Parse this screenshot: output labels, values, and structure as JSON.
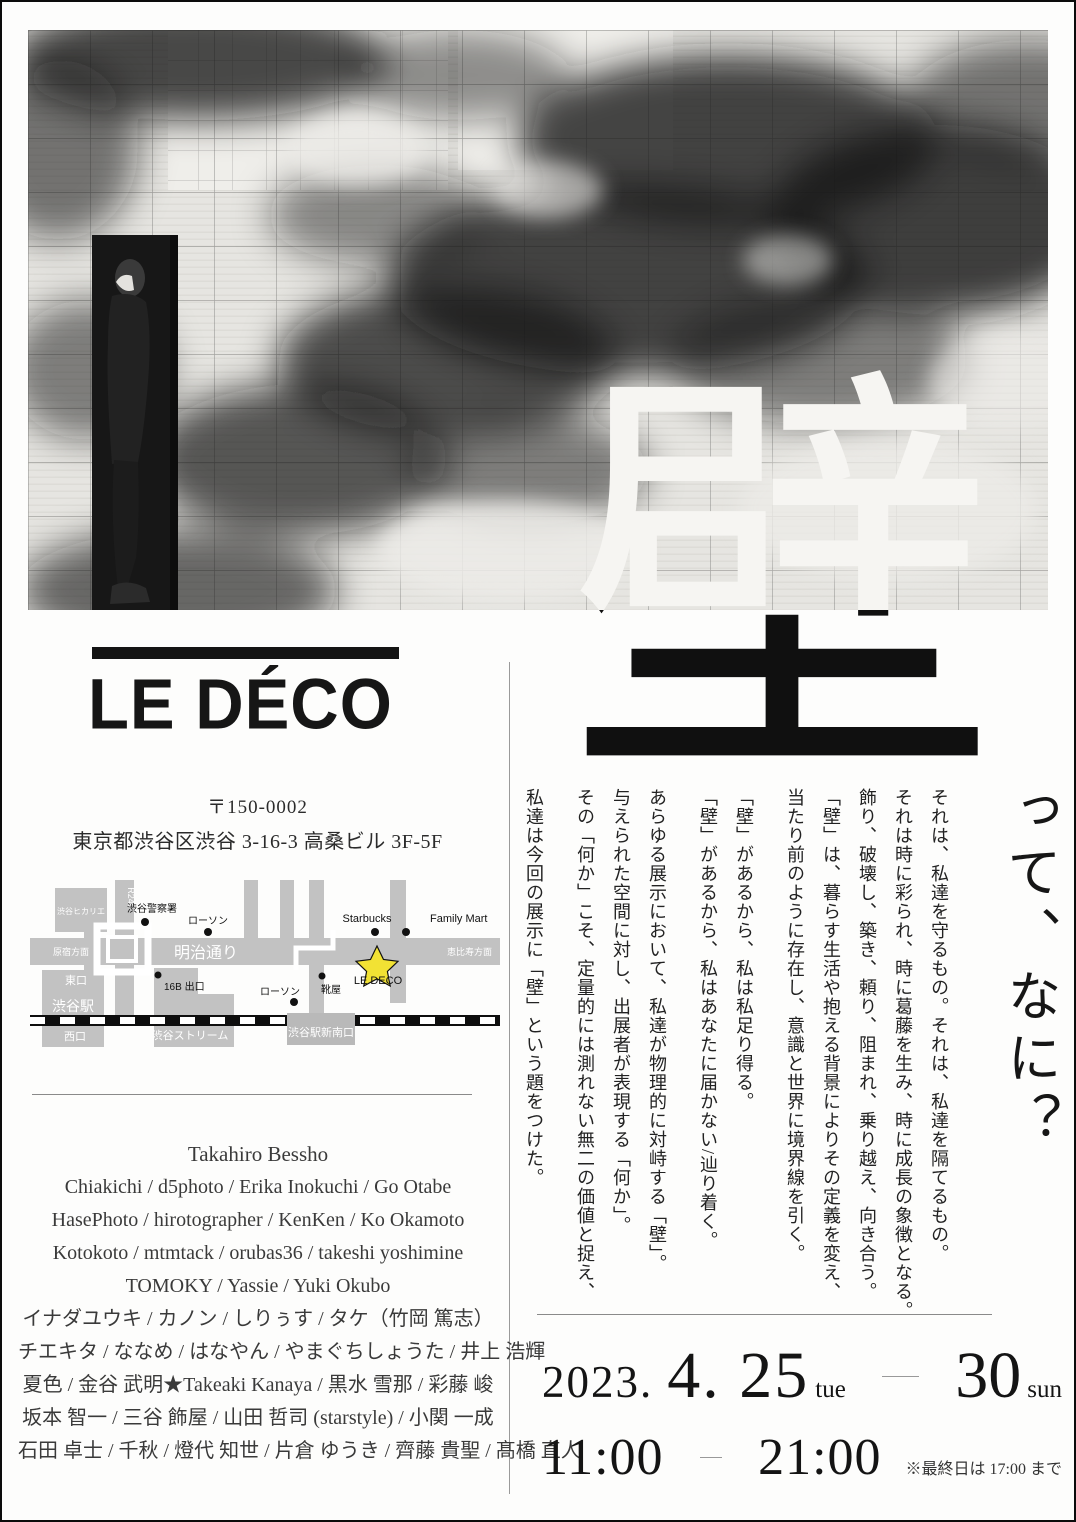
{
  "big_kanji": "壁",
  "heading_suffix": "って、なに？",
  "logo": "LE DÉCO",
  "address": {
    "postal": "〒150-0002",
    "street": "東京都渋谷区渋谷 3-16-3 高桑ビル 3F-5F"
  },
  "map": {
    "hikarie": "渋谷ヒカリエ",
    "r246": "R246",
    "police": "渋谷警察署",
    "lawson1": "ローソン",
    "meiji_dori": "明治通り",
    "harajuku": "原宿方面",
    "ebisu": "恵比寿方面",
    "higashi_guchi": "東口",
    "shibuya_station": "渋谷駅",
    "nishi_guchi": "西口",
    "exit_16b": "16B 出口",
    "shibuya_stream": "渋谷ストリーム",
    "lawson2": "ローソン",
    "kutsuya": "靴屋",
    "starbucks": "Starbucks",
    "family_mart": "Family Mart",
    "le_deco": "LE DECO",
    "shin_minami_guchi": "渋谷駅新南口",
    "star_color": "#f2e234",
    "road_color": "#c2c2c2"
  },
  "essay": {
    "paragraphs": [
      "それは、私達を守るもの。それは、私達を隔てるもの。\nそれは時に彩られ、時に葛藤を生み、時に成長の象徴となる。\n飾り、破壊し、築き、頼り、阻まれ、乗り越え、向き合う。\n「壁」は、暮らす生活や抱える背景によりその定義を変え、\n当たり前のように存在し、意識と世界に境界線を引く。",
      "「壁」があるから、私は私足り得る。\n「壁」があるから、私はあなたに届かない/辿り着く。",
      "あらゆる展示において、私達が物理的に対峙する「壁」。\n与えられた空間に対し、出展者が表現する「何か」。\nその「何か」こそ、定量的には測れない無二の価値と捉え、",
      "私達は今回の展示に「壁」という題をつけた。"
    ]
  },
  "artists": {
    "lines": [
      "Takahiro Bessho",
      "Chiakichi / d5photo / Erika Inokuchi / Go Otabe",
      "HasePhoto / hirotographer / KenKen / Ko Okamoto",
      "Kotokoto / mtmtack / orubas36 / takeshi yoshimine",
      "TOMOKY /  Yassie / Yuki Okubo",
      "イナダユウキ / カノン / しりぅす / タケ（竹岡 篤志）",
      "チエキタ / ななめ / はなやん / やまぐちしょうた / 井上 浩輝",
      "夏色 / 金谷 武明★Takeaki Kanaya / 黒水 雪那 / 彩藤 峻",
      "坂本 智一 / 三谷 飾屋 / 山田 哲司 (starstyle) / 小関 一成",
      "石田 卓士 / 千秋 / 燈代 知世 / 片倉 ゆうき / 齊藤 貴聖 / 髙橋 直人"
    ]
  },
  "date": {
    "year": "2023.",
    "start_day": "4. 25",
    "start_dow": "tue",
    "end_day": "30",
    "end_dow": "sun"
  },
  "time": {
    "open": "11:00",
    "close": "21:00",
    "note": "※最終日は 17:00 まで"
  }
}
